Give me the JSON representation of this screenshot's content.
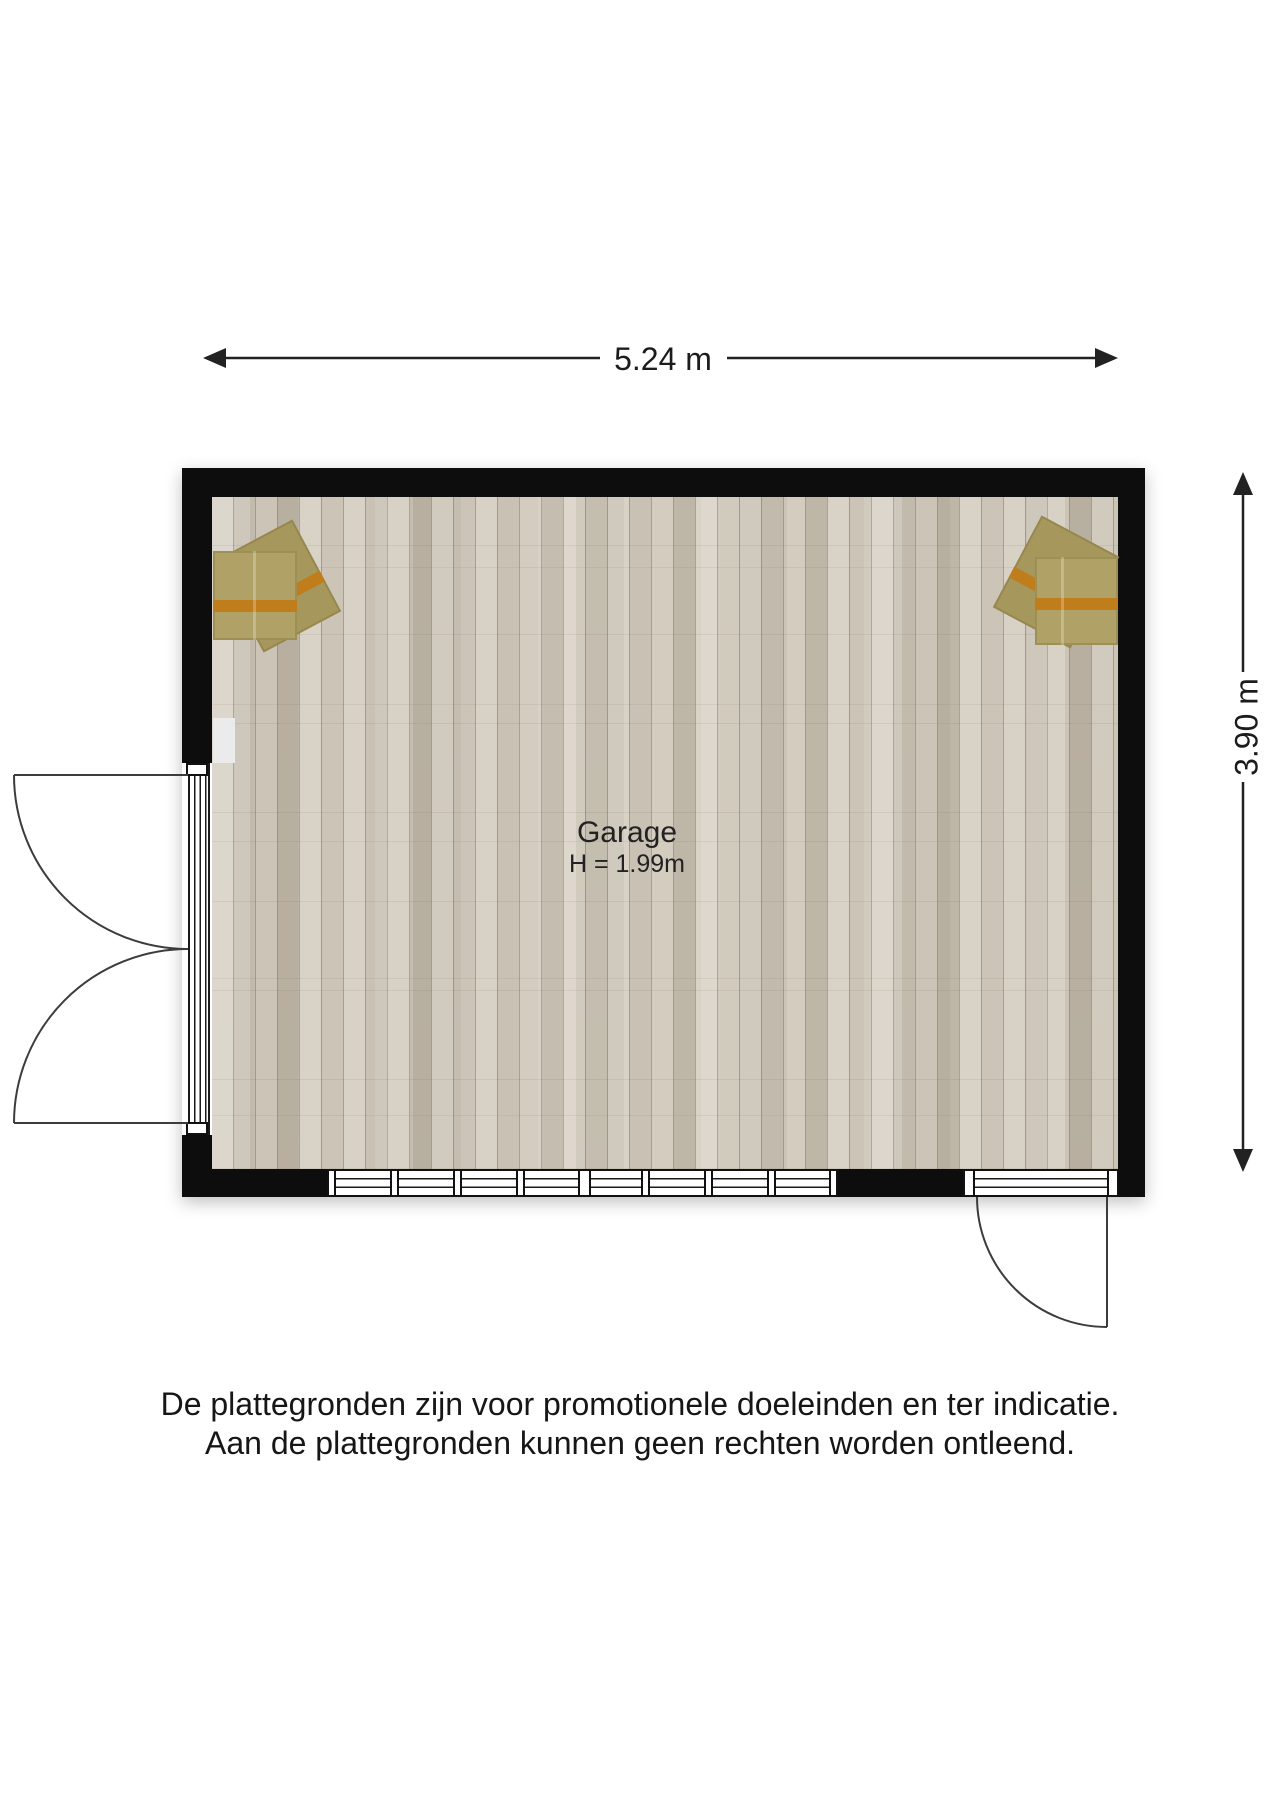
{
  "plan": {
    "room_label": "Garage",
    "room_height_label": "H = 1.99m",
    "dim_width_label": "5.24 m",
    "dim_height_label": "3.90 m"
  },
  "disclaimer": {
    "line1": "De plattegronden zijn voor promotionele doeleinden en ter indicatie.",
    "line2": "Aan de plattegronden kunnen geen rechten worden ontleend."
  },
  "objects": {
    "left_corner": "cardboard-boxes",
    "right_corner": "cardboard-boxes"
  },
  "colors": {
    "wall": "#0d0d0d",
    "floor_base": "#d2cbbe",
    "box": "#b0a267",
    "box_tape": "#bf7d1b",
    "dimension": "#222222",
    "door_line": "#3c3c3c"
  }
}
